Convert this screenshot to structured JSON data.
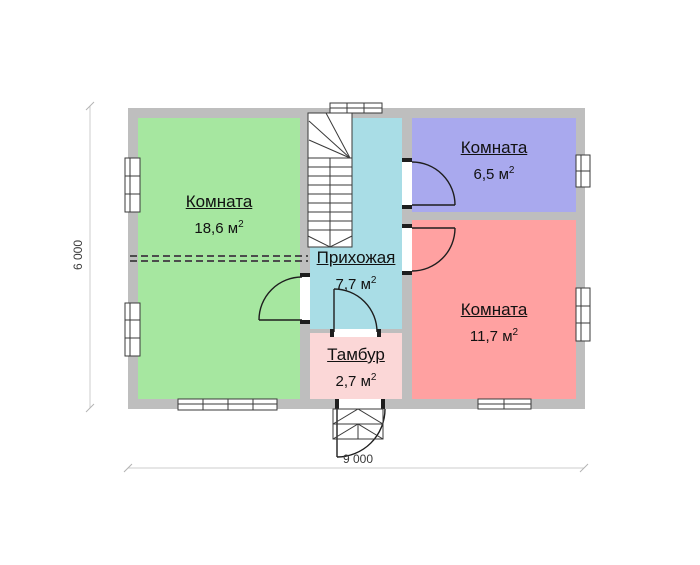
{
  "plan": {
    "title": "floor-plan",
    "rooms": [
      {
        "id": "room-large",
        "name": "Комната",
        "area": "18,6"
      },
      {
        "id": "room-small",
        "name": "Комната",
        "area": "6,5"
      },
      {
        "id": "room-medium",
        "name": "Комната",
        "area": "11,7"
      },
      {
        "id": "hallway",
        "name": "Прихожая",
        "area": "7,7"
      },
      {
        "id": "tambour",
        "name": "Тамбур",
        "area": "2,7"
      }
    ],
    "unit": "м",
    "unit_sup": "2",
    "dimensions": {
      "width": "9 000",
      "height": "6 000"
    },
    "colors": {
      "wall": "#bebebe",
      "room_large": "#a6e7a0",
      "room_small": "#a9a9ee",
      "room_medium": "#ffa1a1",
      "hallway": "#a9dde6",
      "tambour": "#fbd7d7"
    }
  }
}
